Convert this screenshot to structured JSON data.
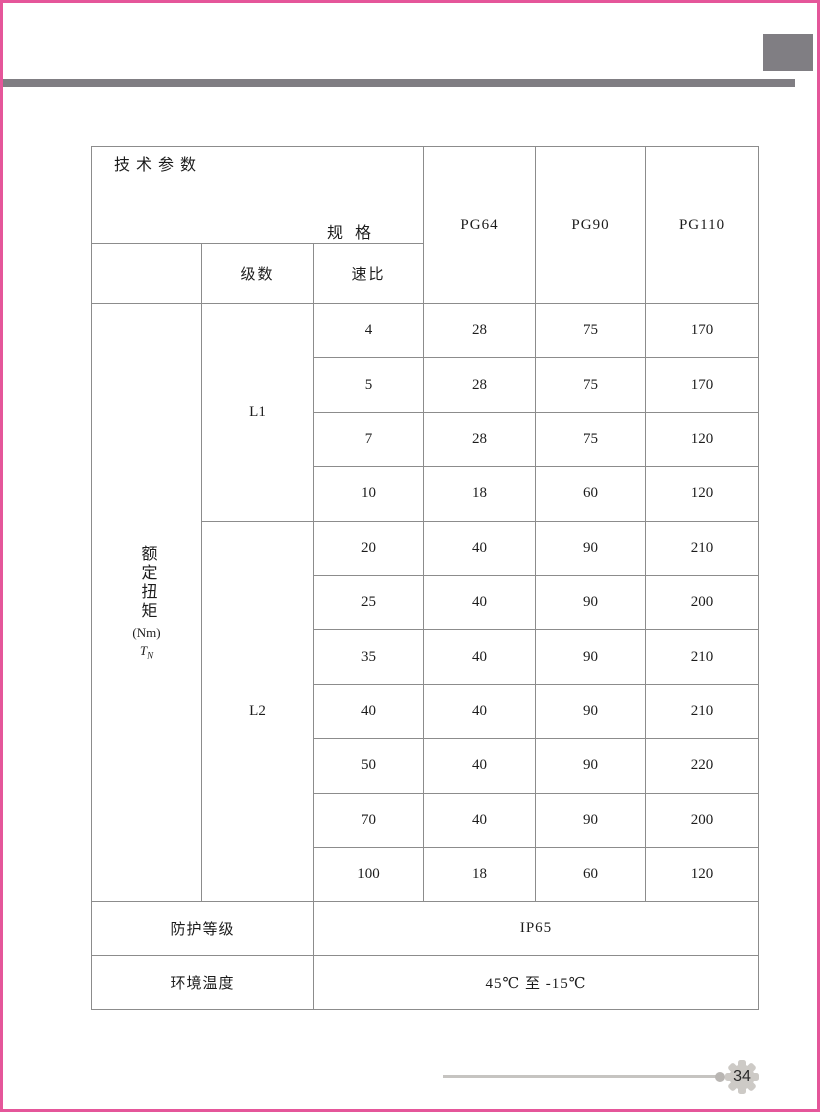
{
  "accent": {
    "border_pink": "#e5569a",
    "bar_gray": "#807e83",
    "cell_shade": "#d7d3ce",
    "table_line": "#8c8c8c",
    "footer_gray": "#c6c4c1"
  },
  "header": {
    "spec_label": "规 格",
    "params_label": "技术参数",
    "columns": [
      "PG64",
      "PG90",
      "PG110"
    ],
    "stages_label": "级数",
    "ratio_label": "速比"
  },
  "torque": {
    "name": "额定扭矩",
    "unit": "(Nm)",
    "symbol": "T",
    "symbol_sub": "N"
  },
  "groups": {
    "l1": "L1",
    "l2": "L2"
  },
  "rows": [
    {
      "ratio": "4",
      "pg64": "28",
      "pg90": "75",
      "pg110": "170"
    },
    {
      "ratio": "5",
      "pg64": "28",
      "pg90": "75",
      "pg110": "170"
    },
    {
      "ratio": "7",
      "pg64": "28",
      "pg90": "75",
      "pg110": "120"
    },
    {
      "ratio": "10",
      "pg64": "18",
      "pg90": "60",
      "pg110": "120"
    },
    {
      "ratio": "20",
      "pg64": "40",
      "pg90": "90",
      "pg110": "210"
    },
    {
      "ratio": "25",
      "pg64": "40",
      "pg90": "90",
      "pg110": "200"
    },
    {
      "ratio": "35",
      "pg64": "40",
      "pg90": "90",
      "pg110": "210"
    },
    {
      "ratio": "40",
      "pg64": "40",
      "pg90": "90",
      "pg110": "210"
    },
    {
      "ratio": "50",
      "pg64": "40",
      "pg90": "90",
      "pg110": "220"
    },
    {
      "ratio": "70",
      "pg64": "40",
      "pg90": "90",
      "pg110": "200"
    },
    {
      "ratio": "100",
      "pg64": "18",
      "pg90": "60",
      "pg110": "120"
    }
  ],
  "footer_rows": {
    "protection_label": "防护等级",
    "protection_value": "IP65",
    "temperature_label": "环境温度",
    "temperature_value": "45℃ 至 -15℃"
  },
  "page": {
    "number": "34"
  }
}
